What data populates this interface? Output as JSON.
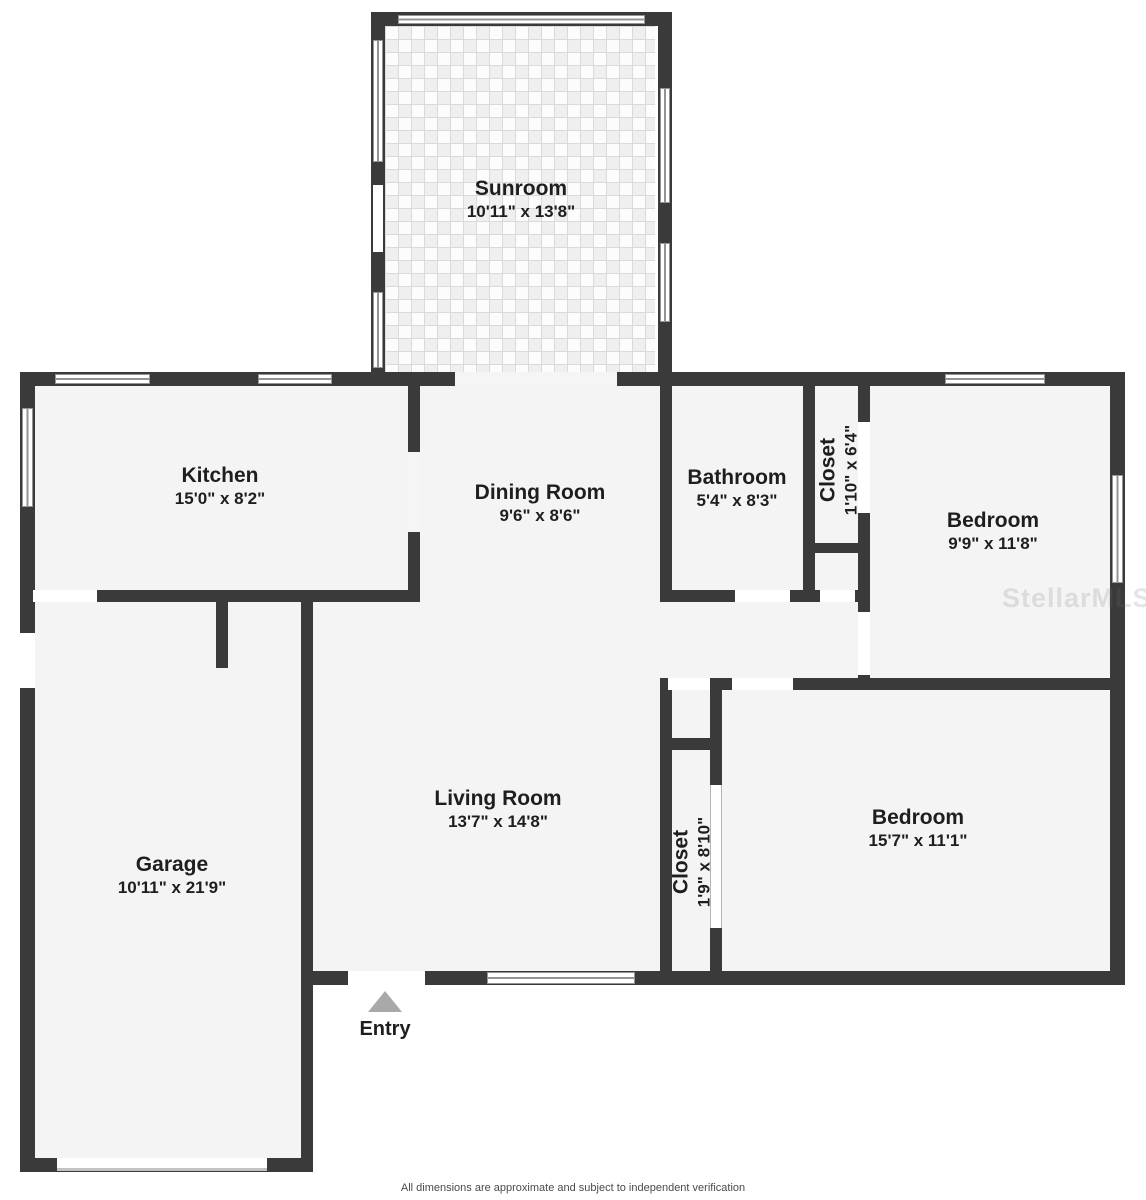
{
  "rooms": [
    {
      "id": "sunroom",
      "name": "Sunroom",
      "dims": "10'11\" x 13'8\""
    },
    {
      "id": "kitchen",
      "name": "Kitchen",
      "dims": "15'0\" x 8'2\""
    },
    {
      "id": "dining-room",
      "name": "Dining Room",
      "dims": "9'6\" x 8'6\""
    },
    {
      "id": "bathroom",
      "name": "Bathroom",
      "dims": "5'4\" x 8'3\""
    },
    {
      "id": "closet-top",
      "name": "Closet",
      "dims": "1'10\" x 6'4\""
    },
    {
      "id": "bedroom-top",
      "name": "Bedroom",
      "dims": "9'9\" x 11'8\""
    },
    {
      "id": "garage",
      "name": "Garage",
      "dims": "10'11\" x 21'9\""
    },
    {
      "id": "living-room",
      "name": "Living Room",
      "dims": "13'7\" x 14'8\""
    },
    {
      "id": "closet-bottom",
      "name": "Closet",
      "dims": "1'9\" x 8'10\""
    },
    {
      "id": "bedroom-bottom",
      "name": "Bedroom",
      "dims": "15'7\" x 11'1\""
    }
  ],
  "entry": {
    "label": "Entry"
  },
  "watermark": {
    "text": "StellarMLS"
  },
  "footer": {
    "text": "All dimensions are approximate and subject to independent verification"
  },
  "colors": {
    "wall": "#3a3a3a",
    "floor": "#f4f4f4",
    "entry_arrow": "#a9a9a9"
  }
}
